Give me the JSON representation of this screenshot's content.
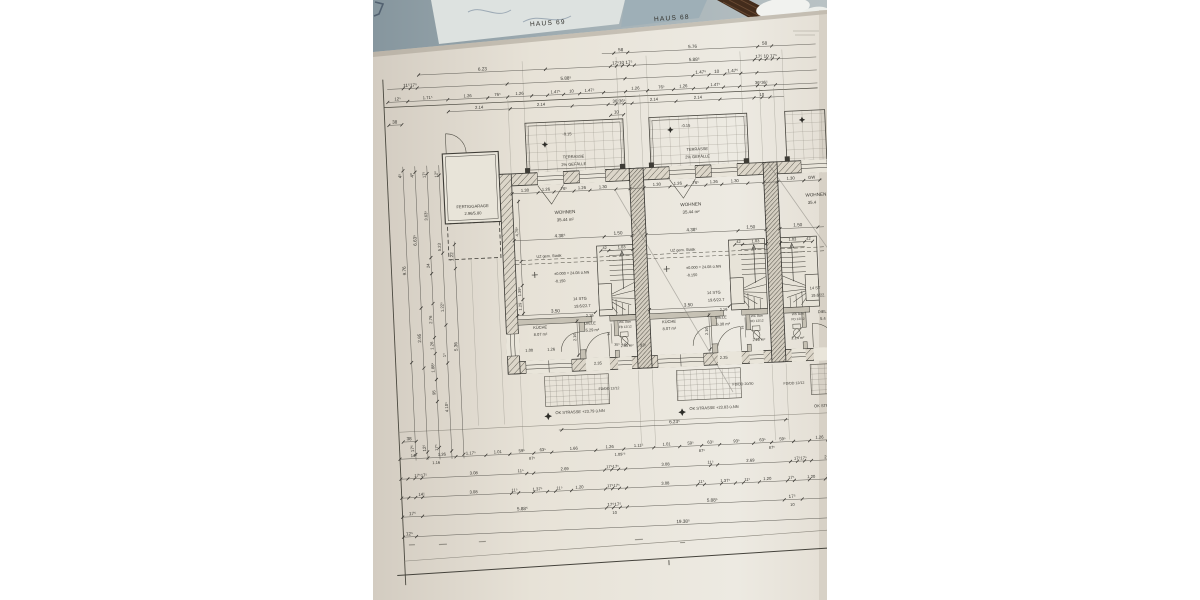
{
  "titles": {
    "haus_left": "HAUS 69",
    "haus_right": "HAUS 68"
  },
  "garage": {
    "name": "FERTIGGARAGE",
    "size": "2.96/5.80"
  },
  "terrace": {
    "name": "TERRASSE",
    "slope": "2% GEFÄLLE",
    "level": "-0.15"
  },
  "units": {
    "left": {
      "wohnen": "WOHNEN",
      "wohnen_area": "35.44 m²",
      "kueche": "KÜCHE",
      "kueche_area": "8.07 m²",
      "diele": "DIELE",
      "diele_area": "5.29 m²",
      "wc": "WC 8cm",
      "wc_fb": "FB 12/12",
      "wc_area": "2.35 m²",
      "stg1": "14 STG",
      "stg2": "19.6/22.7",
      "uz": "UZ gem. Statik",
      "lvl0": "±0.000 = 24.08 ü.NN",
      "lvlm": "-0.150"
    },
    "mid": {
      "wohnen": "WOHNEN",
      "wohnen_area": "35.44 m²",
      "kueche": "KÜCHE",
      "kueche_area": "8.07 m²",
      "diele": "DIELE",
      "diele_area": "5.30 m²",
      "wc": "WC 8cm",
      "wc_fb": "FD 12/12",
      "wc_area": "2.28 m²",
      "stg1": "14 STG",
      "stg2": "19.6/22.7",
      "uz": "UZ gem. Statik",
      "lvl0": "±0.000 = 24.08 ü.NN",
      "lvlm": "-0.150"
    },
    "right": {
      "wohnen": "WOHNEN",
      "wohnen_area": "35.4",
      "diele": "DIELE",
      "diele_area": "5.4",
      "wc": "WS 8cm",
      "wc_fb": "FD 12/12",
      "wc_area": "2.14 m²",
      "stg1": "14 ST",
      "stg2": "19.6/22."
    }
  },
  "street": {
    "ok_left": "OK STRASSE +23.79 ü.NN",
    "ok_mid": "OK STRASSE +23.83 ü.NN",
    "ok_right": "OK STRASSE",
    "fd_left": "FD/DD 12/12",
    "fd_mid": "FD/DD 20/30",
    "fd_right": "FD/DD 12/12"
  },
  "dim_rows": [
    {
      "y": 54,
      "x1": 240,
      "x2": 454,
      "ticks": [
        252,
        266,
        396,
        410
      ],
      "labels": [
        [
          "58",
          259
        ],
        [
          "5.76",
          331
        ],
        [
          "58",
          403
        ]
      ]
    },
    {
      "y": 67,
      "x1": 56,
      "x2": 454,
      "ticks": [
        56,
        183,
        248,
        254,
        260,
        266,
        272,
        392,
        398,
        404,
        410,
        416
      ],
      "labels": [
        [
          "6.23",
          120
        ],
        [
          "17⁵10 17⁵",
          260
        ],
        [
          "5.88⁵",
          332
        ],
        [
          "17⁵ 10 17⁵",
          404
        ]
      ]
    },
    {
      "y": 80,
      "x1": 24,
      "x2": 454,
      "ticks": [
        40,
        47,
        54,
        144,
        262,
        330,
        346,
        362,
        378,
        394
      ],
      "labels": [
        [
          "11⁵17⁵",
          47
        ],
        [
          "5.88⁵",
          203
        ],
        [
          "1.47⁵",
          338
        ],
        [
          "10",
          354
        ],
        [
          "1.47⁵",
          370
        ]
      ]
    },
    {
      "y": 93,
      "x1": 24,
      "x2": 454,
      "fs": 4.2,
      "ticks": [
        24,
        44,
        84,
        124,
        144,
        168,
        184,
        200,
        216,
        240,
        262,
        284,
        310,
        330,
        344,
        360,
        376,
        394,
        402,
        412
      ],
      "labels": [
        [
          "12⁵",
          34
        ],
        [
          "1.71⁵",
          64
        ],
        [
          "1.26",
          104
        ],
        [
          "76⁵",
          134
        ],
        [
          "1.26",
          156
        ],
        [
          "1.47⁵",
          192
        ],
        [
          "10",
          208
        ],
        [
          "1.47⁵",
          226
        ],
        [
          "1.26",
          272
        ],
        [
          "76⁵",
          298
        ],
        [
          "1.26",
          320
        ],
        [
          "1.47⁵",
          352
        ],
        [
          "36⁵36⁵",
          398
        ]
      ]
    },
    {
      "y": 105,
      "x1": 84,
      "x2": 420,
      "fs": 4.2,
      "ticks": [
        84,
        146,
        208,
        244,
        252,
        260,
        268,
        312,
        356,
        390,
        398,
        406
      ],
      "labels": [
        [
          "2.14",
          115
        ],
        [
          "2.14",
          177
        ],
        [
          "36⁵36⁵",
          255
        ],
        [
          "2.14",
          290
        ],
        [
          "2.14",
          334
        ],
        [
          "10",
          398
        ]
      ]
    },
    {
      "y": 116,
      "x1": 24,
      "x2": 37,
      "ticks": [
        24,
        37
      ],
      "labels": [
        [
          "38",
          30
        ]
      ]
    },
    {
      "y": 116,
      "x1": 246,
      "x2": 259,
      "ticks": [
        246,
        259
      ],
      "labels": [
        [
          "10",
          252
        ]
      ]
    },
    {
      "y": 190,
      "x1": 144,
      "x2": 454,
      "fs": 4.2,
      "ticks": [
        144,
        170,
        186,
        206,
        222,
        248,
        262,
        276,
        302,
        318,
        338,
        354,
        380,
        396,
        410,
        436,
        452
      ],
      "labels": [
        [
          "1.30",
          157
        ],
        [
          "1.26",
          178
        ],
        [
          "76⁵",
          196
        ],
        [
          "1.26",
          214
        ],
        [
          "1.30",
          235
        ],
        [
          "1.30",
          289
        ],
        [
          "1.26",
          310
        ],
        [
          "76⁵",
          328
        ],
        [
          "1.26",
          346
        ],
        [
          "1.30",
          367
        ],
        [
          "1.30",
          423
        ],
        [
          "GW",
          444
        ]
      ]
    },
    {
      "y": 237,
      "x1": 144,
      "x2": 262,
      "ticks": [
        144,
        234,
        262
      ],
      "labels": [
        [
          "4.38⁵",
          190
        ],
        [
          "1.50",
          248
        ]
      ]
    },
    {
      "y": 251,
      "x1": 230,
      "x2": 262,
      "fs": 4,
      "ticks": [
        230,
        238,
        262
      ],
      "labels": [
        [
          "42",
          234
        ],
        [
          "1.03",
          251
        ]
      ]
    },
    {
      "y": 312,
      "x1": 144,
      "x2": 222,
      "ticks": [
        144,
        222
      ],
      "labels": [
        [
          "3.50",
          182
        ]
      ]
    },
    {
      "y": 318,
      "fs": 4,
      "labels": [
        [
          "2.16",
          216
        ]
      ]
    },
    {
      "y": 237,
      "x1": 276,
      "x2": 396,
      "ticks": [
        276,
        368,
        396
      ],
      "labels": [
        [
          "4.38⁵",
          322
        ],
        [
          "1.50",
          381
        ]
      ]
    },
    {
      "y": 251,
      "x1": 364,
      "x2": 396,
      "fs": 4,
      "ticks": [
        364,
        372,
        396
      ],
      "labels": [
        [
          "42",
          368
        ],
        [
          "1.03",
          385
        ]
      ]
    },
    {
      "y": 312,
      "x1": 276,
      "x2": 356,
      "ticks": [
        276,
        356
      ],
      "labels": [
        [
          "3.50",
          315
        ]
      ]
    },
    {
      "y": 318,
      "fs": 4,
      "labels": [
        [
          "2.16",
          350
        ]
      ]
    },
    {
      "y": 237,
      "x1": 410,
      "x2": 454,
      "ticks": [
        410,
        448
      ],
      "labels": [
        [
          "1.50",
          428
        ]
      ]
    },
    {
      "y": 251,
      "x1": 410,
      "x2": 442,
      "fs": 4,
      "ticks": [
        410,
        434,
        442
      ],
      "labels": [
        [
          "1.03",
          422
        ],
        [
          "42",
          438
        ]
      ]
    },
    {
      "y": 350,
      "fs": 4,
      "labels": [
        [
          "1.00",
          154
        ],
        [
          "1.26",
          176
        ],
        [
          "93⁵",
          268
        ]
      ]
    },
    {
      "y": 348,
      "fs": 3.6,
      "labels": [
        [
          "35⁵",
          242
        ],
        [
          "2",
          250
        ]
      ]
    },
    {
      "y": 366,
      "fs": 4,
      "labels": [
        [
          "2.35",
          222
        ],
        [
          "2.35",
          348
        ]
      ]
    },
    {
      "y": 428,
      "x1": 180,
      "x2": 410,
      "ticks": [
        183,
        407
      ],
      "labels": [
        [
          "6.23⁵",
          296
        ]
      ]
    },
    {
      "y": 433,
      "x1": 24,
      "x2": 37,
      "ticks": [
        24,
        37
      ],
      "labels": [
        [
          "38",
          30
        ]
      ]
    },
    {
      "y": 450,
      "x1": 20,
      "x2": 454,
      "fs": 4.2,
      "ticks": [
        20,
        48,
        76,
        106,
        130,
        154,
        172,
        216,
        244,
        274,
        300,
        322,
        340,
        374,
        392,
        414,
        430,
        448
      ],
      "labels": [
        [
          "14⁵",
          34
        ],
        [
          "1.26",
          62
        ],
        [
          "1.17⁵",
          91
        ],
        [
          "1.01",
          118
        ],
        [
          "59⁵",
          142
        ],
        [
          "63⁵",
          163
        ],
        [
          "1.66",
          194
        ],
        [
          "1.26",
          230
        ],
        [
          "1.11⁵",
          259
        ],
        [
          "1.01",
          287
        ],
        [
          "59⁵",
          311
        ],
        [
          "63⁵",
          331
        ],
        [
          "93⁵",
          357
        ],
        [
          "63⁵",
          383
        ],
        [
          "59⁵",
          403
        ],
        [
          "1.26",
          440
        ]
      ]
    },
    {
      "y": 458,
      "fs": 4,
      "labels": [
        [
          "1.16",
          56
        ],
        [
          "87⁵",
          152
        ],
        [
          "1.09⁷⁵",
          240
        ],
        [
          "87⁵",
          322
        ],
        [
          "87⁵",
          392
        ]
      ]
    },
    {
      "y": 470,
      "x1": 20,
      "x2": 454,
      "fs": 4.2,
      "ticks": [
        20,
        27,
        34,
        41,
        146,
        153,
        224,
        231,
        238,
        245,
        330,
        337,
        410,
        417,
        424,
        431
      ],
      "labels": [
        [
          "17⁵17⁵",
          40
        ],
        [
          "3.08",
          93
        ],
        [
          "11⁵",
          140
        ],
        [
          "2.69",
          184
        ],
        [
          "17⁵17⁵",
          232
        ],
        [
          "3.08",
          285
        ],
        [
          "11⁵",
          330
        ],
        [
          "2.69",
          370
        ],
        [
          "17⁵17⁵",
          420
        ],
        [
          "2.69",
          448
        ]
      ]
    },
    {
      "y": 489,
      "x1": 20,
      "x2": 454,
      "fs": 4.2,
      "ticks": [
        20,
        27,
        34,
        41,
        130,
        137,
        152,
        166,
        174,
        190,
        224,
        231,
        238,
        245,
        316,
        323,
        340,
        354,
        362,
        378,
        406,
        413,
        428,
        444,
        451
      ],
      "labels": [
        [
          "14⁵",
          40
        ],
        [
          "3.08",
          92
        ],
        [
          "11⁵",
          133
        ],
        [
          "1.37⁵",
          156
        ],
        [
          "11⁵",
          178
        ],
        [
          "1.20",
          198
        ],
        [
          "17⁵17⁵",
          232
        ],
        [
          "3.08",
          284
        ],
        [
          "11⁵",
          320
        ],
        [
          "1.37⁵",
          344
        ],
        [
          "11⁵",
          366
        ],
        [
          "1.20",
          386
        ],
        [
          "17⁵",
          410
        ],
        [
          "1.20",
          430
        ],
        [
          "11⁵",
          448
        ]
      ]
    },
    {
      "y": 508,
      "x1": 20,
      "x2": 454,
      "ticks": [
        20,
        40,
        224,
        231,
        238,
        245,
        402,
        420
      ],
      "labels": [
        [
          "17⁵",
          30
        ],
        [
          "5.88⁵",
          140
        ],
        [
          "17⁵17⁵",
          232
        ],
        [
          "5.88⁵",
          330
        ],
        [
          "17⁵",
          410
        ]
      ]
    },
    {
      "y": 516,
      "fs": 4,
      "labels": [
        [
          "10",
          232
        ],
        [
          "10",
          410
        ]
      ]
    },
    {
      "y": 528,
      "x1": 20,
      "x2": 454,
      "ticks": [
        20,
        33,
        450
      ],
      "labels": [
        [
          "12⁵",
          26
        ],
        [
          "19.38⁵",
          300
        ]
      ]
    }
  ],
  "dim_cols": [
    {
      "x": 36,
      "y1": 158,
      "y2": 452,
      "ticks": [
        162,
        354,
        446
      ],
      "labels": [
        [
          "4⁵",
          167
        ],
        [
          "9.76",
          262
        ],
        [
          "17⁵",
          440
        ]
      ]
    },
    {
      "x": 48,
      "y1": 158,
      "y2": 452,
      "ticks": [
        164,
        300,
        360,
        444
      ],
      "labels": [
        [
          "4⁰",
          167
        ],
        [
          "6.63⁵",
          232
        ],
        [
          "2.95",
          330
        ],
        [
          "12⁵",
          440
        ]
      ]
    },
    {
      "x": 60,
      "y1": 158,
      "y2": 452,
      "fs": 4.2,
      "ticks": [
        166,
        250,
        266,
        296,
        330,
        346,
        372,
        394,
        440
      ],
      "labels": [
        [
          "17⁵",
          167
        ],
        [
          "3.63⁵",
          208
        ],
        [
          "24",
          258
        ],
        [
          "2.76",
          312
        ],
        [
          "1.26",
          338
        ],
        [
          "1.88⁵",
          360
        ],
        [
          "95",
          385
        ],
        [
          "17⁵",
          440
        ]
      ]
    },
    {
      "x": 72,
      "y1": 158,
      "y2": 452,
      "fs": 4.2,
      "ticks": [
        168,
        246,
        318,
        356,
        444
      ],
      "labels": [
        [
          "12⁰",
          167
        ],
        [
          "5.23",
          240
        ],
        [
          "1.22⁵",
          300
        ],
        [
          "1⁵",
          348
        ],
        [
          "4.10⁵",
          400
        ]
      ]
    },
    {
      "x": 84,
      "y1": 235,
      "y2": 452,
      "ticks": [
        238,
        262,
        448
      ],
      "labels": [
        [
          "1.22",
          250
        ],
        [
          "5.36",
          340
        ]
      ]
    },
    {
      "x": 150,
      "y1": 196,
      "y2": 312,
      "fs": 4,
      "ticks": [
        198,
        258,
        282,
        296,
        310
      ],
      "labels": [
        [
          "4.75⁵",
          228
        ],
        [
          "1.39⁵",
          288
        ],
        [
          "1.29",
          303
        ]
      ]
    },
    {
      "x": 203,
      "y1": 318,
      "y2": 356,
      "fs": 4,
      "ticks": [
        320,
        354
      ],
      "labels": [
        [
          "2.16",
          336
        ]
      ]
    },
    {
      "x": 335,
      "y1": 318,
      "y2": 356,
      "fs": 4,
      "ticks": [
        320,
        354
      ],
      "labels": [
        [
          "2.16",
          336
        ]
      ]
    },
    {
      "x": 237,
      "y1": 324,
      "y2": 344,
      "fs": 3.6,
      "labels": [
        [
          "74",
          334
        ]
      ]
    },
    {
      "x": 371,
      "y1": 324,
      "y2": 344,
      "fs": 3.6,
      "labels": [
        [
          "74",
          334
        ]
      ]
    }
  ]
}
